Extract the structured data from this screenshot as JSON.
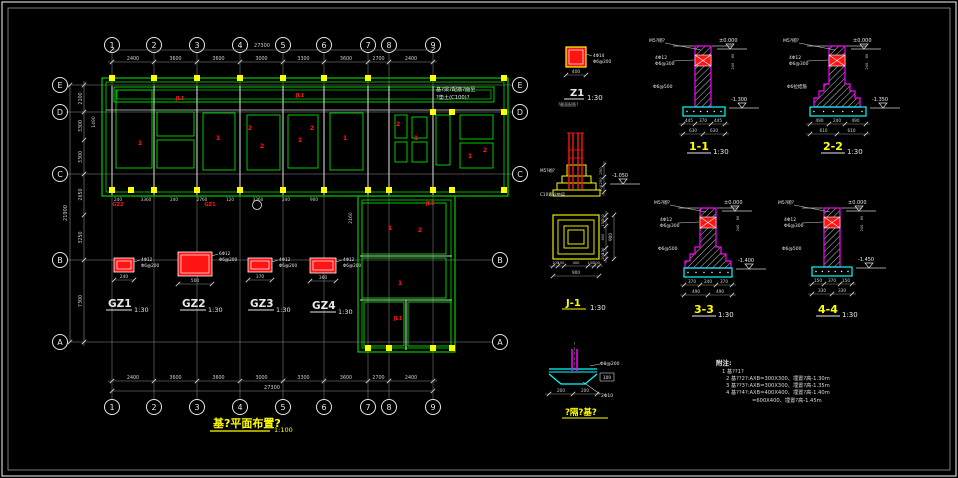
{
  "app": {
    "type": "cad-foundation-drawing",
    "background": "#000000"
  },
  "colors": {
    "line": "#e8e8e8",
    "grid": "#8f8f8f",
    "green": "#00dd00",
    "yellow": "#ffff00",
    "red": "#ff1414",
    "magenta": "#ff00ff",
    "cyan": "#00ffff",
    "dim": "#cfcfcf"
  },
  "plan": {
    "title": "基?平面布置?",
    "scale": "1:100",
    "grid_cols": [
      "1",
      "2",
      "3",
      "4",
      "5",
      "6",
      "7",
      "8",
      "9"
    ],
    "grid_rows": [
      "E",
      "D",
      "C",
      "B",
      "A"
    ],
    "top_dims": [
      "2400",
      "3600",
      "3600",
      "3000",
      "3300",
      "3600",
      "2700",
      "2400"
    ],
    "bottom_dims": [
      "2400",
      "3600",
      "3600",
      "3000",
      "3300",
      "3600",
      "2700",
      "2400"
    ],
    "overall_width": "27300",
    "left_dims": [
      "2100",
      "3300",
      "3300",
      "2650",
      "3250",
      "7300"
    ],
    "overall_height": "21900",
    "side_note": [
      "基?梁?配筋?面至",
      "?垫土(C100)?"
    ],
    "red_marks": [
      "JL1",
      "JL1",
      "JL1",
      "1",
      "1",
      "2",
      "2",
      "1",
      "2",
      "1",
      "2",
      "1",
      "1",
      "2",
      "1",
      "2",
      "1",
      "JL1",
      "GZ2",
      "GZ1"
    ],
    "micro_dims": [
      "240",
      "3360",
      "240",
      "2760",
      "120",
      "3360",
      "240",
      "900"
    ],
    "rotated_dims": [
      "1490",
      "2160"
    ]
  },
  "gz_details": [
    {
      "label": "GZ1",
      "scale": "1:30",
      "width": "240",
      "rebar": "4Φ12",
      "stirrup": "Φ6@200"
    },
    {
      "label": "GZ2",
      "scale": "1:30",
      "width": "500",
      "rebar": "6Φ12",
      "stirrup": "Φ6@200"
    },
    {
      "label": "GZ3",
      "scale": "1:30",
      "width": "370",
      "rebar": "4Φ12",
      "stirrup": "Φ6@200"
    },
    {
      "label": "GZ4",
      "scale": "1:30",
      "width": "360",
      "rebar": "4Φ12",
      "stirrup": "Φ6@200"
    }
  ],
  "z1": {
    "label": "Z1",
    "scale": "1:30",
    "dim": "400",
    "rebar": "4Φ14",
    "stirrup": "Φ6@200",
    "subtext": "?截面配筋?"
  },
  "j1": {
    "label": "J-1",
    "scale": "1:30",
    "plan_dims": [
      "100",
      "150",
      "400",
      "150",
      "100"
    ],
    "plan_total": "900",
    "side_dims": [
      "100",
      "150",
      "400",
      "150",
      "100"
    ],
    "side_total": "900",
    "pier_dims": [
      "250",
      "250",
      "100"
    ],
    "pier_level": "-1.050",
    "pier_note_1": "M5?砌?",
    "pier_note_2": "C10素砼垫层"
  },
  "trench": {
    "label": "?隔?基?",
    "bar_note": "Φ8@200",
    "bar_note2": "2Φ10",
    "depth": "100",
    "dims": [
      "200",
      "200"
    ]
  },
  "sections": [
    {
      "label": "1-1",
      "scale": "1:30",
      "top_level": "±0.000",
      "bottom_level": "-1.300",
      "beam_rebar": "4Φ12",
      "beam_stirrup": "Φ6@300",
      "wall_note": "M5?砌?",
      "tie_note": "Φ6@500",
      "dims_row1": [
        "445",
        "370",
        "445"
      ],
      "dims_row2": [
        "630",
        "630"
      ],
      "side_dims": [
        "60",
        "240"
      ]
    },
    {
      "label": "2-2",
      "scale": "1:30",
      "top_level": "±0.000",
      "bottom_level": "-1.350",
      "beam_rebar": "4Φ12",
      "beam_stirrup": "Φ6@300",
      "wall_note": "M5?砌?",
      "tie_note": "Φ6拉结筋",
      "dims_row1": [
        "490",
        "240",
        "490"
      ],
      "dims_row2": [
        "610",
        "610"
      ],
      "side_dims": [
        "60",
        "240"
      ]
    },
    {
      "label": "3-3",
      "scale": "1:30",
      "top_level": "±0.000",
      "bottom_level": "-1.400",
      "beam_rebar": "4Φ12",
      "beam_stirrup": "Φ6@300",
      "wall_note": "M5?砌?",
      "tie_note": "Φ6@500",
      "dims_row1": [
        "370",
        "240",
        "370"
      ],
      "dims_row2": [
        "490",
        "490"
      ],
      "side_dims": [
        "60",
        "240"
      ]
    },
    {
      "label": "4-4",
      "scale": "1:30",
      "top_level": "±0.000",
      "bottom_level": "-1.450",
      "beam_rebar": "4Φ12",
      "beam_stirrup": "Φ6@300",
      "wall_note": "M5?砌?",
      "tie_note": "Φ6@500",
      "dims_row1": [
        "150",
        "370",
        "150"
      ],
      "dims_row2": [
        "330",
        "330"
      ],
      "side_dims": [
        "60",
        "240"
      ]
    }
  ],
  "notes": {
    "title": "附注:",
    "items": [
      "1 基??1?",
      "2 基??2?:AXB=300X300、埋置?高-1.30m",
      "3 基??3?:AXB=300X300、埋置?高-1.35m",
      "4 基??4?:AXB=400X400、埋置?高-1.40m",
      "=600X400、埋置?高-1.45m"
    ]
  }
}
